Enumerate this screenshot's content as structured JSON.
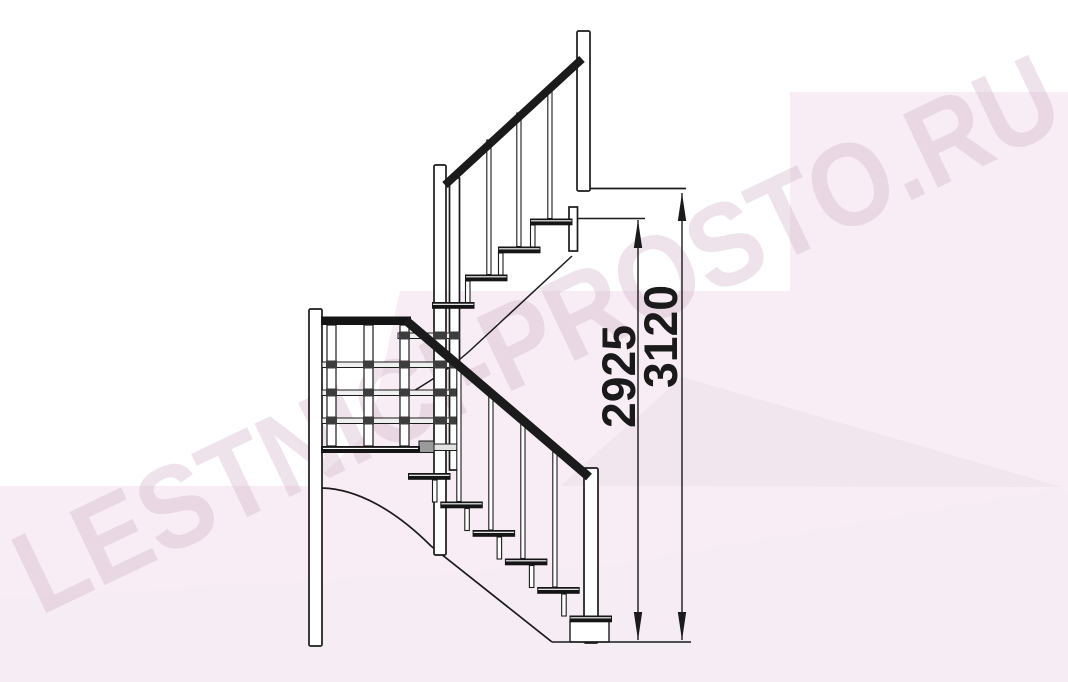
{
  "watermark": {
    "text": "LESTNICI-PROSTO.RU"
  },
  "dimensions": {
    "inner": {
      "value": "2925",
      "unit": "mm",
      "orientation": "vertical"
    },
    "outer": {
      "value": "3120",
      "unit": "mm",
      "orientation": "vertical"
    }
  },
  "colors": {
    "line": "#1b1b1b",
    "background": "#ffffff",
    "pink_base": "#f8edf4",
    "pink_dark_wedge": "#f1e5ee",
    "pink_light_wedge": "#f6ecf3",
    "watermark": "#cdadc2"
  }
}
